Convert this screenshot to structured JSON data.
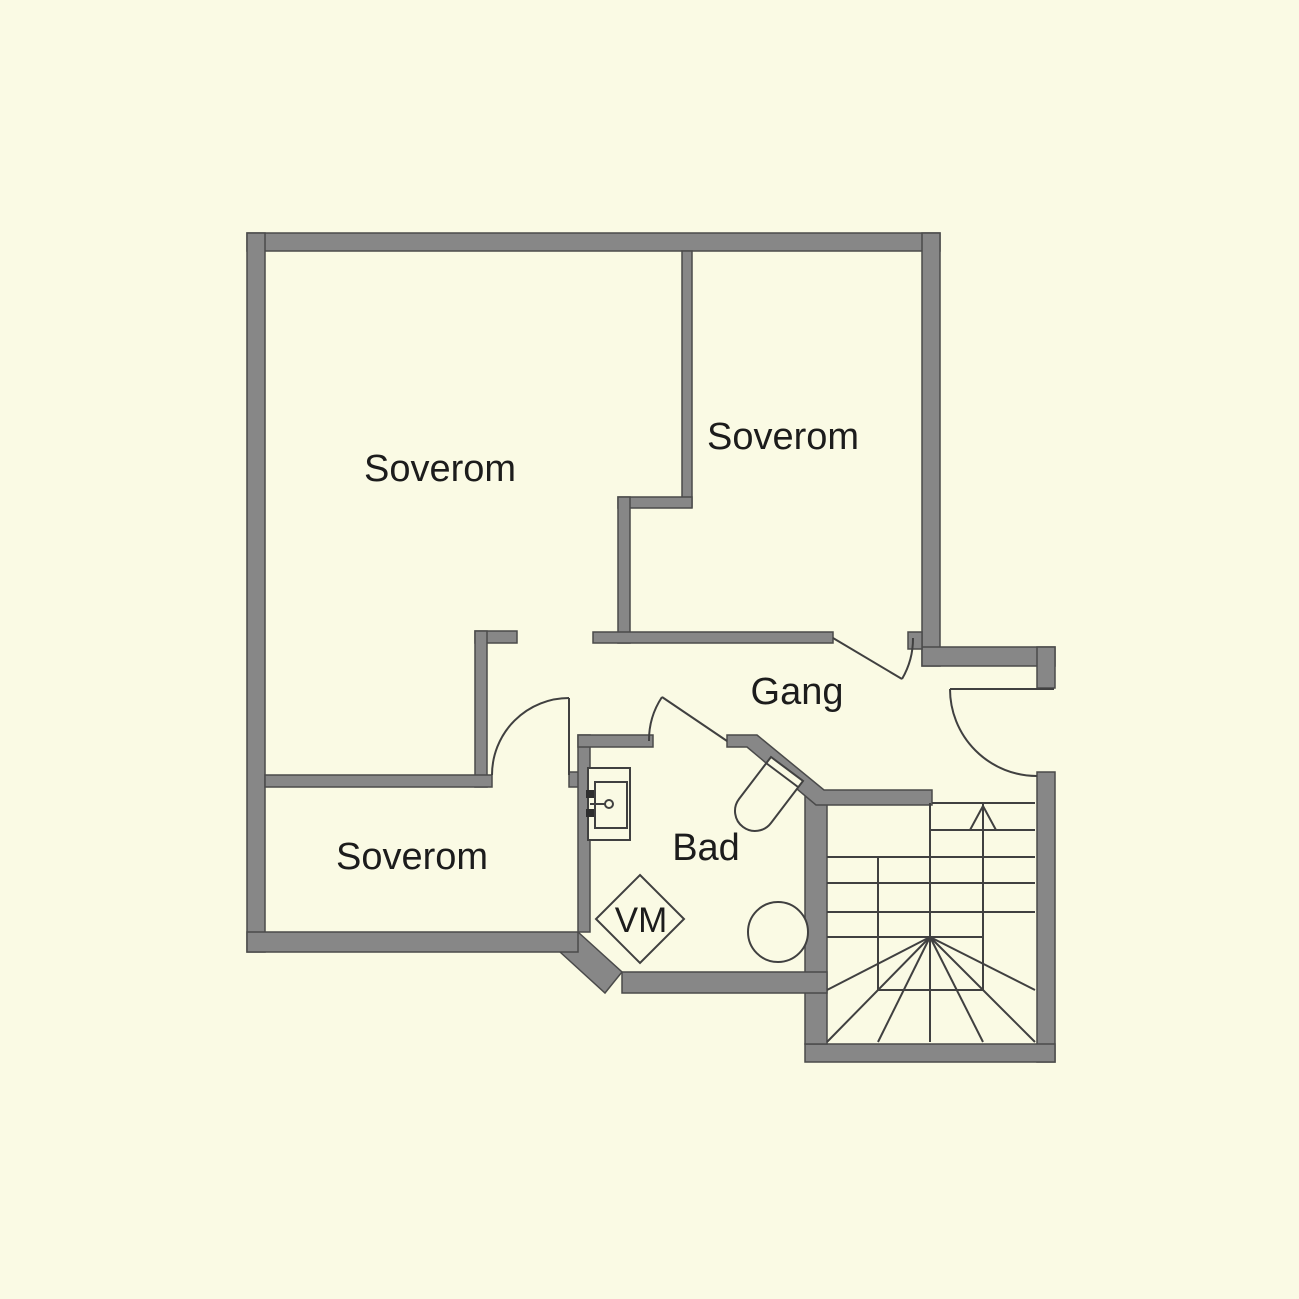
{
  "title": "Floor plan",
  "colors": {
    "background": "#FAFAE4",
    "wall_fill": "#878787",
    "wall_outline": "#4A4A4A",
    "line": "#404040",
    "text": "#1C1C1C"
  },
  "rooms": [
    {
      "id": "soverom-large",
      "label": "Soverom"
    },
    {
      "id": "soverom-right",
      "label": "Soverom"
    },
    {
      "id": "soverom-lower",
      "label": "Soverom"
    },
    {
      "id": "gang",
      "label": "Gang"
    },
    {
      "id": "bad",
      "label": "Bad"
    }
  ],
  "fixtures": {
    "washing_machine_label": "VM"
  },
  "stairs": {
    "type": "winder-staircase",
    "direction": "up"
  }
}
